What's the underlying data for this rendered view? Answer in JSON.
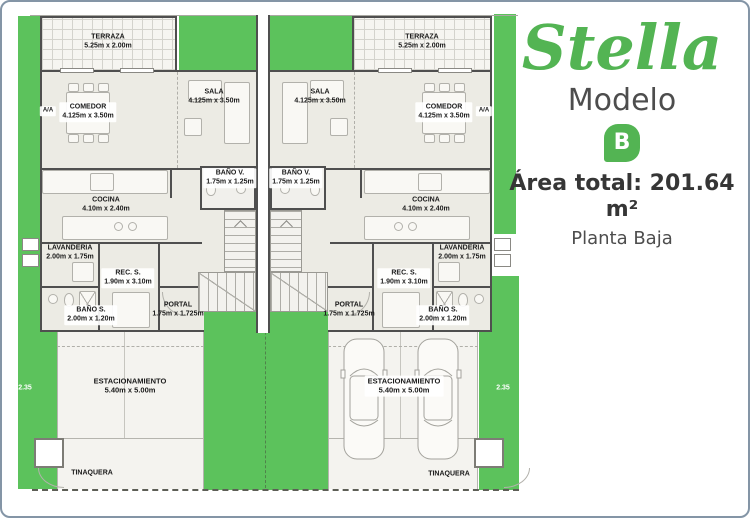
{
  "panel": {
    "brand": "Stella",
    "model_label": "Modelo",
    "model_letter": "B",
    "area_total": "Área total: 201.64 m²",
    "floor": "Planta Baja"
  },
  "rooms": {
    "terraza": {
      "name": "TERRAZA",
      "dims": "5.25m x 2.00m"
    },
    "comedor": {
      "name": "COMEDOR",
      "dims": "4.125m x 3.50m"
    },
    "sala": {
      "name": "SALA",
      "dims": "4.125m x 3.50m"
    },
    "bano_v": {
      "name": "BAÑO V.",
      "dims": "1.75m x 1.25m"
    },
    "cocina": {
      "name": "COCINA",
      "dims": "4.10m x 2.40m"
    },
    "lavanderia": {
      "name": "LAVANDERIA",
      "dims": "2.00m x 1.75m"
    },
    "rec_s": {
      "name": "REC. S.",
      "dims": "1.90m x 3.10m"
    },
    "bano_s": {
      "name": "BAÑO S.",
      "dims": "2.00m x 1.20m"
    },
    "portal": {
      "name": "PORTAL",
      "dims": "1.75m x 1.725m"
    },
    "estacionamiento": {
      "name": "ESTACIONAMIENTO",
      "dims": "5.40m x 5.00m"
    },
    "tinaquera": {
      "name": "TINAQUERA"
    },
    "aa": {
      "name": "A/A"
    }
  },
  "dims_markers": {
    "left": "2.35",
    "right": "2.35"
  },
  "colors": {
    "grass": "#5cc25c",
    "brand_green": "#53b453",
    "floor": "#ecebe4",
    "wall": "#4f4f4f"
  }
}
